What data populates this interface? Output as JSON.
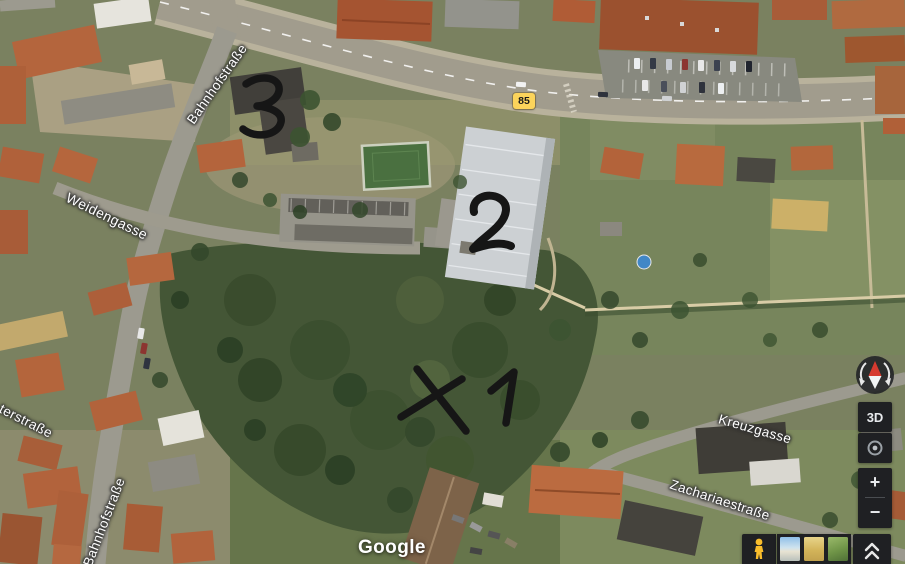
{
  "map": {
    "street_labels": [
      {
        "id": "bahnhofstrasse-top",
        "text": "Bahnhofstraße"
      },
      {
        "id": "weidengasse",
        "text": "Weidengasse"
      },
      {
        "id": "terstrasse",
        "text": "terstraße"
      },
      {
        "id": "bahnhofstrasse-bottom",
        "text": "Bahnhofstraße"
      },
      {
        "id": "kreuzgasse",
        "text": "Kreuzgasse"
      },
      {
        "id": "zachariaestrasse",
        "text": "Zachariaestraße"
      }
    ],
    "route_shield": {
      "number": "85"
    },
    "annotations": [
      {
        "label": "3"
      },
      {
        "label": "2"
      },
      {
        "label": "X"
      },
      {
        "label": "1"
      }
    ]
  },
  "branding": {
    "logo_text": "Google"
  },
  "controls": {
    "tilt_button_label": "3D",
    "zoom_in_label": "+",
    "zoom_out_label": "−"
  },
  "colors": {
    "route_shield_bg": "#fcd45b",
    "annotation_ink": "#161616",
    "compass_north": "#d63a2f",
    "pegman_yellow": "#f9bd2c",
    "control_bg": "#1f2023",
    "label_text": "#ffffff"
  }
}
